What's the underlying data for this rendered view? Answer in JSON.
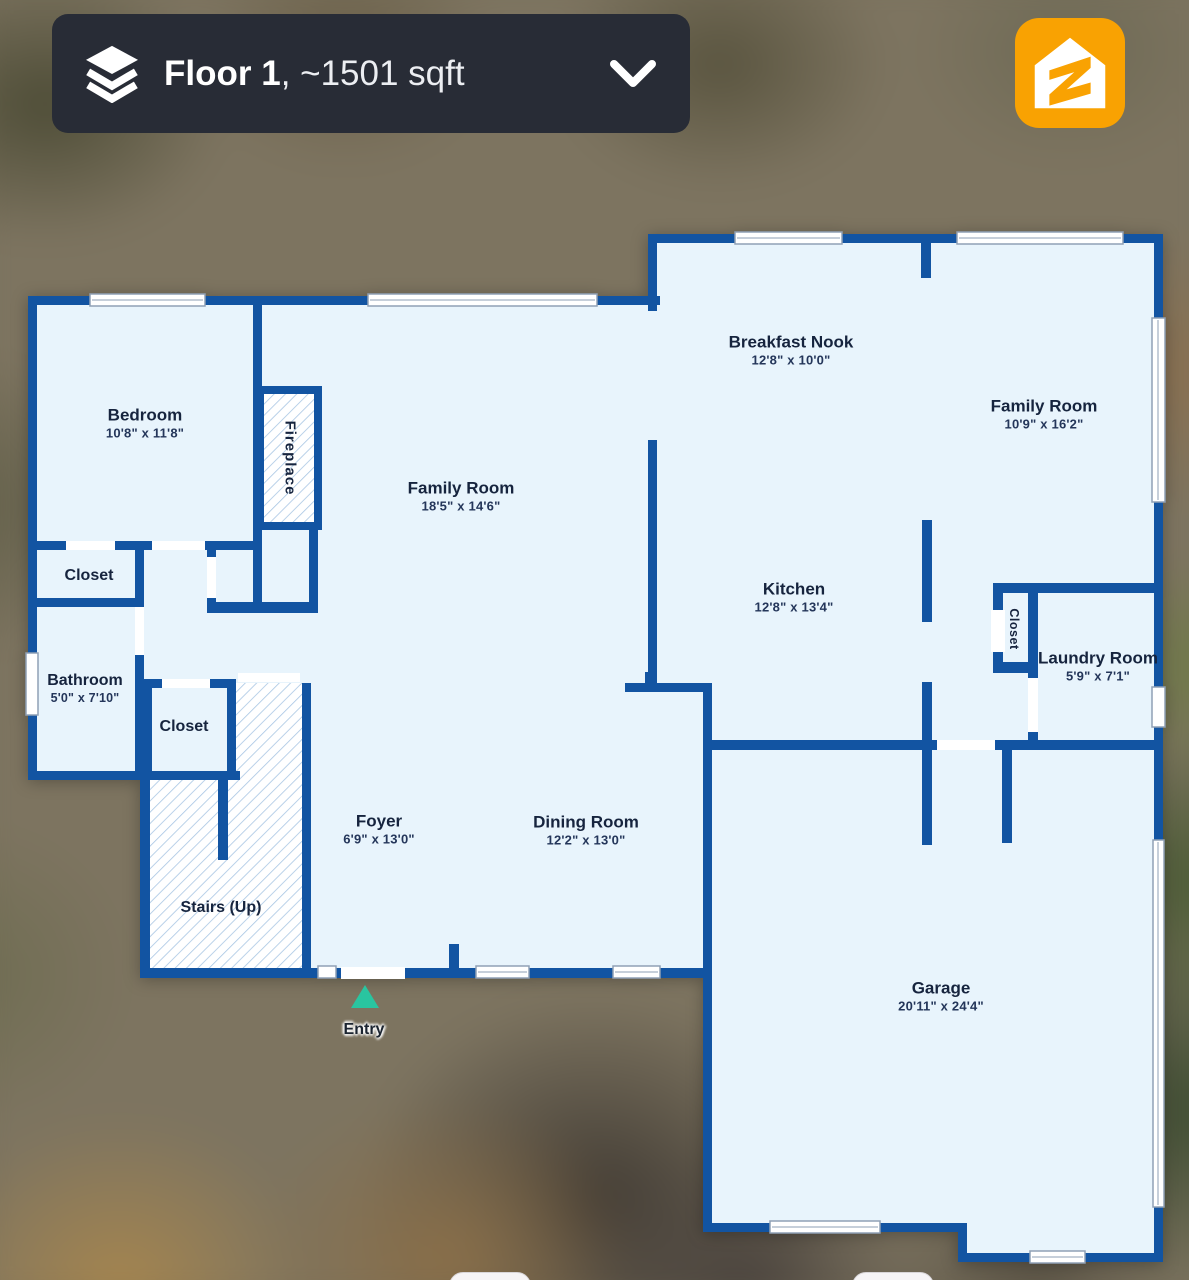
{
  "header": {
    "floor_label": "Floor 1",
    "area_label": ", ~1501 sqft"
  },
  "logo": {
    "brand": "Zillow"
  },
  "colors": {
    "wall": "#1254a2",
    "floor": "#e8f4fc",
    "hatch_line": "#a9c6e4",
    "window_frame": "#8fa0b5",
    "entry_arrow": "#29c5a0",
    "header_bg": "#282c36",
    "logo_orange": "#f9a202"
  },
  "rooms": {
    "bedroom": {
      "name": "Bedroom",
      "dims": "10'8\" x 11'8\""
    },
    "family_room_left": {
      "name": "Family Room",
      "dims": "18'5\" x 14'6\""
    },
    "breakfast_nook": {
      "name": "Breakfast Nook",
      "dims": "12'8\" x 10'0\""
    },
    "family_room_right": {
      "name": "Family Room",
      "dims": "10'9\" x 16'2\""
    },
    "kitchen": {
      "name": "Kitchen",
      "dims": "12'8\" x 13'4\""
    },
    "laundry_room": {
      "name": "Laundry Room",
      "dims": "5'9\" x 7'1\""
    },
    "bathroom": {
      "name": "Bathroom",
      "dims": "5'0\" x 7'10\""
    },
    "closet_hall": {
      "name": "Closet"
    },
    "closet_foyer": {
      "name": "Closet"
    },
    "closet_laundry": {
      "name": "Closet"
    },
    "stairs": {
      "name": "Stairs (Up)"
    },
    "foyer": {
      "name": "Foyer",
      "dims": "6'9\" x 13'0\""
    },
    "dining_room": {
      "name": "Dining Room",
      "dims": "12'2\" x 13'0\""
    },
    "garage": {
      "name": "Garage",
      "dims": "20'11\" x 24'4\""
    },
    "fireplace": {
      "name": "Fireplace"
    },
    "entry": {
      "name": "Entry"
    }
  }
}
